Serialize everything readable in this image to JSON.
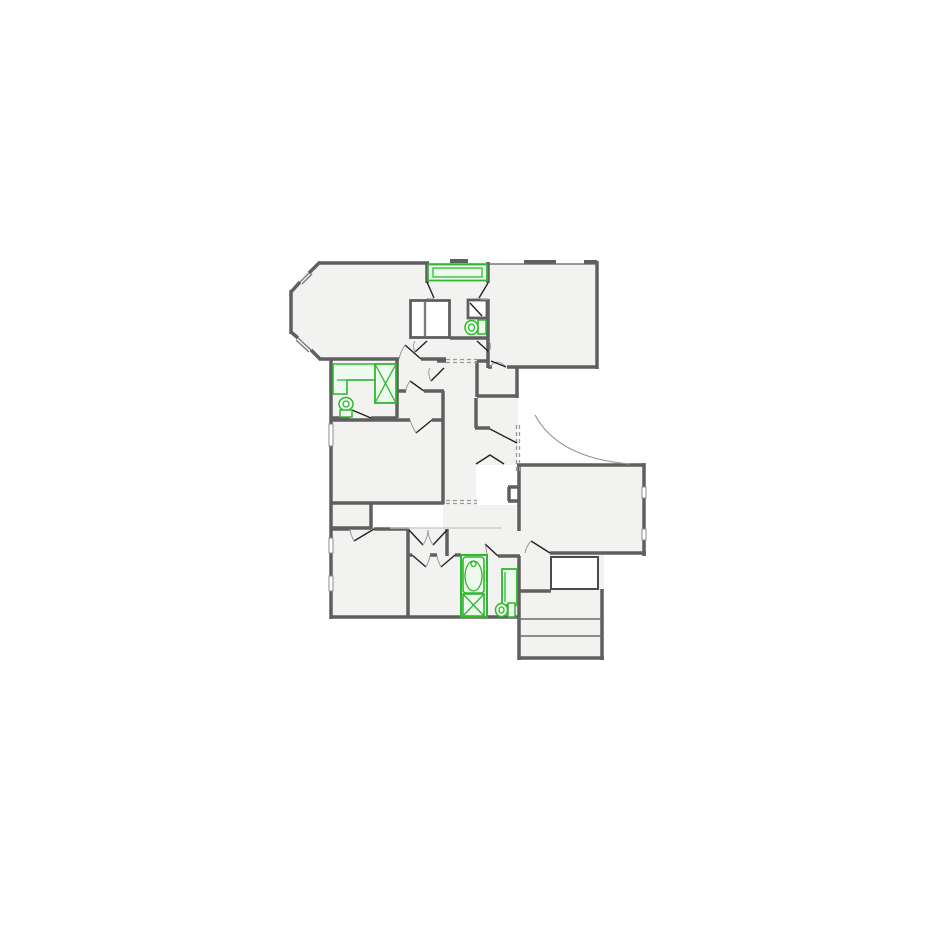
{
  "page": {
    "title": "Floor Plan"
  },
  "colors": {
    "background": "#ffffff",
    "wall": "#5f5f5f",
    "room_fill": "#f2f2f1",
    "thin_line": "#7a7a7a",
    "win_border": "#8c8c8c",
    "door_line": "#222222",
    "arc_line": "#999999",
    "dash_line": "#9a9a9a",
    "light_line": "#c6c6c6",
    "stair_line": "#6b6b6b",
    "void_border": "#4a4a4a",
    "fixture_green": "#2eb82e",
    "fixture_fill": "#effaef",
    "white": "#ffffff"
  },
  "fixtures": [
    {
      "id": "bathtub-upper",
      "type": "bathtub"
    },
    {
      "id": "toilet-upper-bath",
      "type": "toilet"
    },
    {
      "id": "closet-upper",
      "type": "closet"
    },
    {
      "id": "linen-cabinet-upper",
      "type": "cabinet"
    },
    {
      "id": "vanity-counter-left-bath",
      "type": "counter"
    },
    {
      "id": "shower-left-bath",
      "type": "shower"
    },
    {
      "id": "toilet-left-bath",
      "type": "toilet"
    },
    {
      "id": "bathtub-lower-bath",
      "type": "bathtub"
    },
    {
      "id": "shower-lower-bath",
      "type": "shower"
    },
    {
      "id": "vanity-lower-bath",
      "type": "counter"
    },
    {
      "id": "toilet-lower-bath",
      "type": "toilet"
    },
    {
      "id": "staircase",
      "type": "stairs"
    },
    {
      "id": "archway",
      "type": "arched-opening"
    }
  ]
}
